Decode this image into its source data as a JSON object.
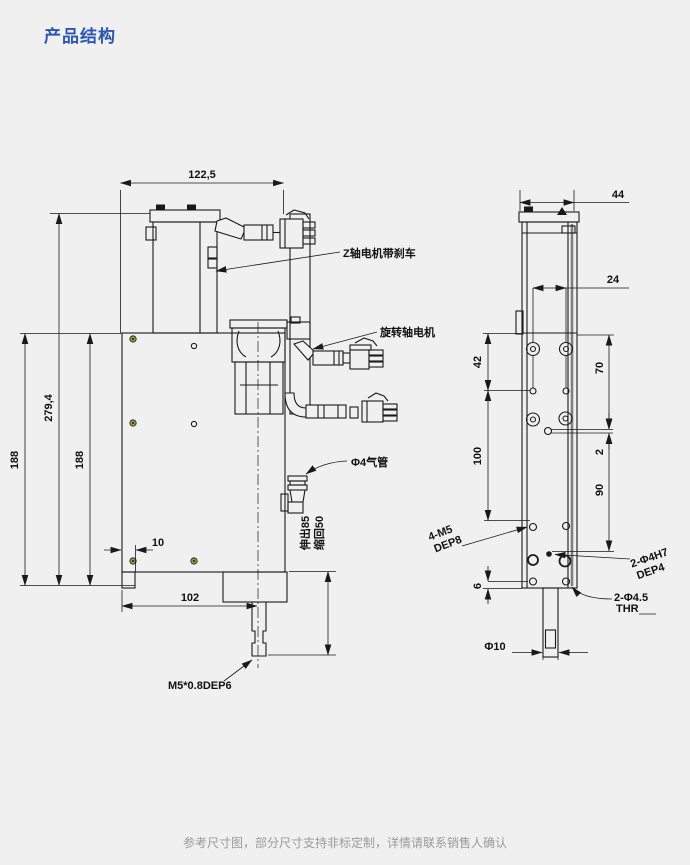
{
  "window": {
    "title": "产品结构",
    "footer": "参考尺寸图，部分尺寸支持非标定制，详情请联系销售人确认"
  },
  "colors": {
    "title_blue": "#2a56b4",
    "line": "#1a1a1a",
    "background": "#f0f0f0",
    "footer_gray": "#9a9a9a",
    "hole_olive": "#9a9a40"
  },
  "front_view": {
    "dims": {
      "width_top": "122,5",
      "height_outer": "188",
      "height_full": "279,4",
      "height_inner": "188",
      "offset_left": "10",
      "width_bottom": "102"
    },
    "labels": {
      "z_motor": "Z轴电机带刹车",
      "rotary_motor": "旋转轴电机",
      "air_tube": "Φ4气管",
      "stroke_extend": "伸出85",
      "stroke_retract": "缩回50",
      "shaft_thread": "M5*0.8DEP6"
    }
  },
  "side_view": {
    "dims": {
      "width_top": "44",
      "hole_pitch": "24",
      "top_offset": "42",
      "hole_span": "100",
      "right_top": "70",
      "right_gap": "2",
      "right_span": "90",
      "bottom_offset": "6",
      "shaft_dia": "Φ10"
    },
    "labels": {
      "tap_line1": "4-M5",
      "tap_line2": "DEP8",
      "dowel_line1": "2-Φ4H7",
      "dowel_line2": "DEP4",
      "thru_line1": "2-Φ4.5",
      "thru_line2": "THR"
    }
  }
}
